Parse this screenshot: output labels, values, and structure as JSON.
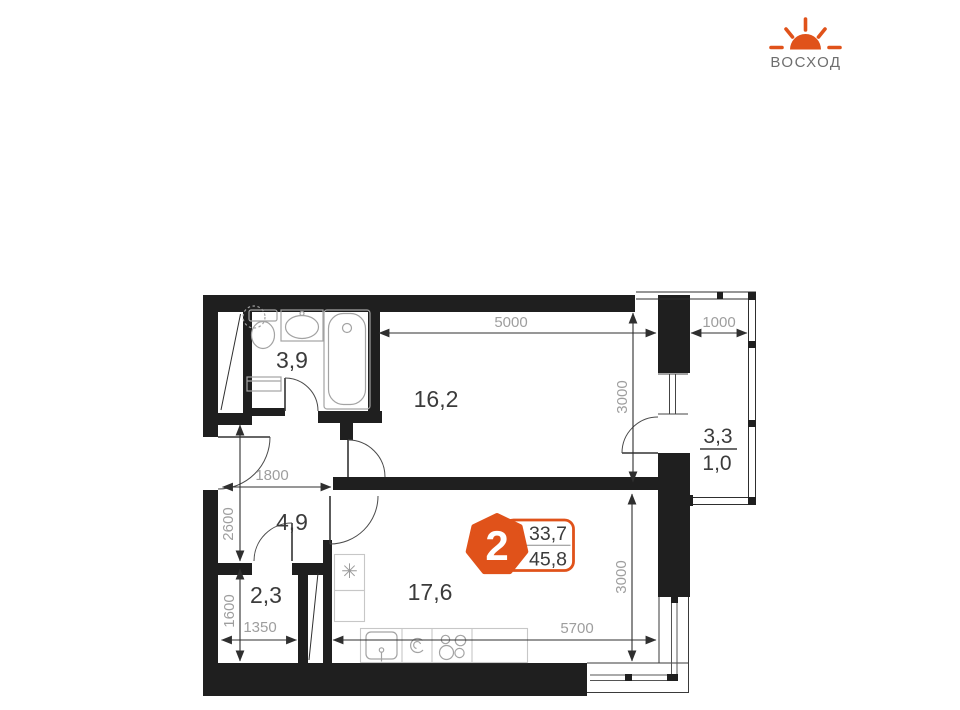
{
  "logo": {
    "brand": "ВОСХОД"
  },
  "unit_badge": {
    "rooms_count": "2",
    "living_area": "33,7",
    "total_area": "45,8"
  },
  "rooms": {
    "bathroom": "3,9",
    "bedroom": "16,2",
    "hallway": "4,9",
    "wardrobe": "2,3",
    "kitchen_living": "17,6",
    "balcony_full": "3,3",
    "balcony_reduced": "1,0"
  },
  "dimensions": {
    "bedroom_width": "5000",
    "balcony_width": "1000",
    "bedroom_depth": "3000",
    "hallway_width": "1800",
    "hallway_depth": "2600",
    "wardrobe_depth": "1600",
    "wardrobe_width": "1350",
    "kitchen_width": "5700",
    "kitchen_depth": "3000"
  },
  "symbols": {
    "fridge_star": "✳"
  }
}
